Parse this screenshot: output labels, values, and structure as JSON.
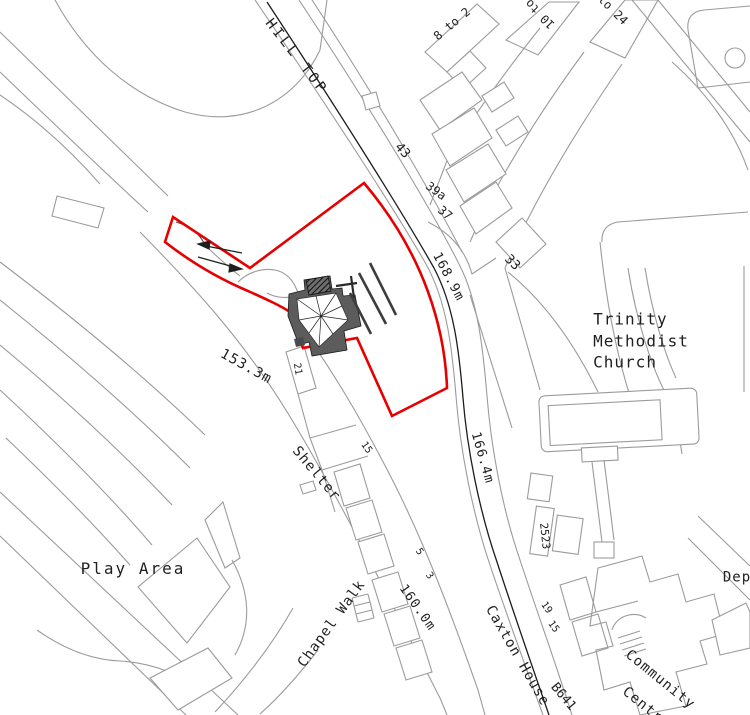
{
  "map": {
    "colors": {
      "background": "#ffffff",
      "linework": "#9b9b9b",
      "road_centerline": "#1c1c1c",
      "site_boundary": "#e60000",
      "proposed_building": "#5c5c5c"
    },
    "labels": [
      {
        "name": "road-hill-top",
        "text": "HILL TOP",
        "x": 296,
        "y": 57,
        "rot": 52,
        "size": 14,
        "ls": 3
      },
      {
        "name": "houses-8-to-2",
        "text": "8 to 2",
        "x": 452,
        "y": 24,
        "rot": -40,
        "size": 12,
        "ls": 0
      },
      {
        "name": "houses-10-to",
        "text": "10 to",
        "x": 540,
        "y": 14,
        "rot": -135,
        "size": 12,
        "ls": 0
      },
      {
        "name": "houses-to-24",
        "text": "to 24",
        "x": 613,
        "y": 10,
        "rot": 45,
        "size": 12,
        "ls": 0
      },
      {
        "name": "house-43",
        "text": "43",
        "x": 402,
        "y": 151,
        "rot": 48,
        "size": 13,
        "ls": 0
      },
      {
        "name": "house-39a",
        "text": "39a",
        "x": 436,
        "y": 191,
        "rot": 36,
        "size": 12,
        "ls": 0
      },
      {
        "name": "house-37",
        "text": "37",
        "x": 445,
        "y": 213,
        "rot": 40,
        "size": 12,
        "ls": 0
      },
      {
        "name": "house-33",
        "text": "33",
        "x": 512,
        "y": 263,
        "rot": 45,
        "size": 13,
        "ls": 0
      },
      {
        "name": "spot-height-168-9m",
        "text": "168.9m",
        "x": 448,
        "y": 277,
        "rot": 62,
        "size": 13,
        "ls": 1
      },
      {
        "name": "spot-height-166-4m",
        "text": "166.4m",
        "x": 482,
        "y": 458,
        "rot": 74,
        "size": 13,
        "ls": 1
      },
      {
        "name": "spot-height-160-0m",
        "text": "160.0m",
        "x": 417,
        "y": 608,
        "rot": 55,
        "size": 13,
        "ls": 1
      },
      {
        "name": "spot-height-153-3m",
        "text": "153.3m",
        "x": 246,
        "y": 367,
        "rot": 29,
        "size": 14,
        "ls": 1
      },
      {
        "name": "shelter-label",
        "text": "Shelter",
        "x": 316,
        "y": 474,
        "rot": 50,
        "size": 14,
        "ls": 1
      },
      {
        "name": "trinity-methodist-church",
        "text": "Trinity\nMethodist\nChurch",
        "x": 641,
        "y": 341,
        "rot": 0,
        "size": 16,
        "ls": 1
      },
      {
        "name": "play-area",
        "text": "Play Area",
        "x": 133,
        "y": 569,
        "rot": 0,
        "size": 16,
        "ls": 2
      },
      {
        "name": "road-chapel-walk",
        "text": "Chapel Walk",
        "x": 332,
        "y": 624,
        "rot": -54,
        "size": 14,
        "ls": 1
      },
      {
        "name": "caxton-house",
        "text": "Caxton House",
        "x": 517,
        "y": 656,
        "rot": 60,
        "size": 14,
        "ls": 1
      },
      {
        "name": "road-b641",
        "text": "B641",
        "x": 563,
        "y": 697,
        "rot": 50,
        "size": 13,
        "ls": 0
      },
      {
        "name": "house-21",
        "text": "21",
        "x": 297,
        "y": 369,
        "rot": 80,
        "size": 10,
        "ls": 0
      },
      {
        "name": "house-15-chapel-walk",
        "text": "15",
        "x": 366,
        "y": 448,
        "rot": 55,
        "size": 10,
        "ls": 0
      },
      {
        "name": "house-5",
        "text": "5",
        "x": 419,
        "y": 552,
        "rot": 55,
        "size": 10,
        "ls": 0
      },
      {
        "name": "house-3",
        "text": "3",
        "x": 429,
        "y": 576,
        "rot": 55,
        "size": 10,
        "ls": 0
      },
      {
        "name": "house-2523",
        "text": "2523",
        "x": 544,
        "y": 536,
        "rot": 84,
        "size": 11,
        "ls": 0
      },
      {
        "name": "house-19",
        "text": "19",
        "x": 546,
        "y": 608,
        "rot": 55,
        "size": 10,
        "ls": 0
      },
      {
        "name": "house-15-caxton",
        "text": "15",
        "x": 553,
        "y": 627,
        "rot": 55,
        "size": 10,
        "ls": 0
      },
      {
        "name": "community-centre-line-1",
        "text": "Community",
        "x": 660,
        "y": 680,
        "rot": 39,
        "size": 14,
        "ls": 1
      },
      {
        "name": "community-centre-line-2",
        "text": "Centre",
        "x": 646,
        "y": 708,
        "rot": 39,
        "size": 14,
        "ls": 1
      },
      {
        "name": "depot",
        "text": "Dep",
        "x": 737,
        "y": 578,
        "rot": 0,
        "size": 14,
        "ls": 1
      }
    ]
  }
}
